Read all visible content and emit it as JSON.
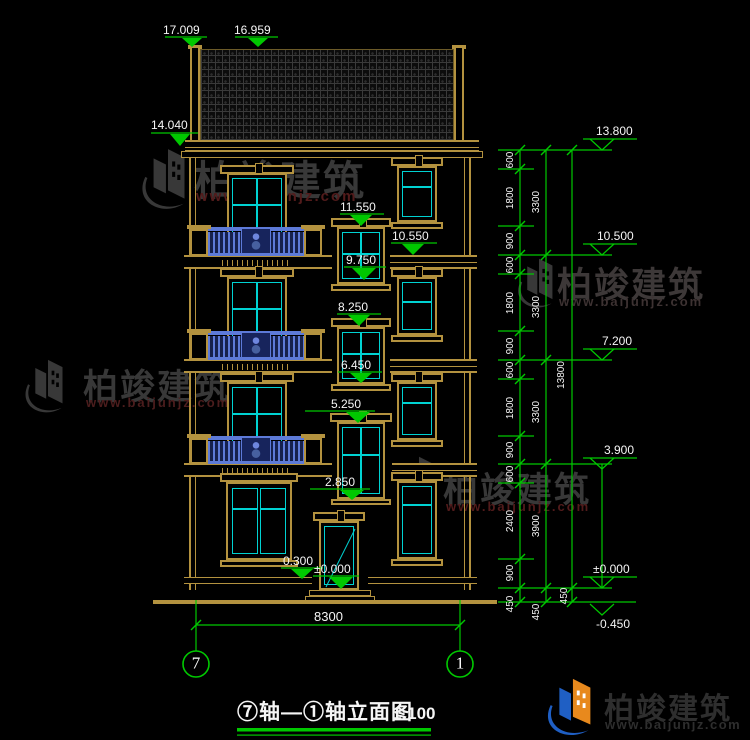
{
  "drawing": {
    "title": "⑦轴—①轴立面图",
    "scale": "1:100",
    "axis_left": "7",
    "axis_right": "1",
    "overall_width": "8300",
    "levels_facade": {
      "ridge_left": "17.009",
      "ridge_right": "16.959",
      "eave": "14.040",
      "w4_top": "11.550",
      "f4_band": "10.550",
      "w4_sill": "9.750",
      "w3_top": "8.250",
      "w3_sill": "6.450",
      "w2_top": "5.250",
      "w2_sill": "2.850",
      "porch": "0.300",
      "zero": "±0.000"
    },
    "levels_right": {
      "parapet": "13.800",
      "floor4": "10.500",
      "floor3": "7.200",
      "floor2": "3.900",
      "zero": "±0.000",
      "ground": "-0.450"
    },
    "dims": {
      "chain_inner": [
        "600",
        "1800",
        "900",
        "600",
        "1800",
        "900",
        "600",
        "1800",
        "900",
        "600",
        "2400",
        "900",
        "450"
      ],
      "chain_floor": [
        "3300",
        "3300",
        "3300",
        "3900",
        "450"
      ],
      "chain_total": [
        "13800",
        "450"
      ]
    }
  },
  "watermark": {
    "name": "柏竣建筑",
    "site": "www.baijunjz.com"
  },
  "logo": {
    "name": "柏竣建筑",
    "site": "www.baijunjz.com"
  },
  "colors": {
    "line_tan": "#b3923f",
    "line_cyan": "#00d2d2",
    "line_green": "#00c800",
    "railing_blue": "#5d7ad8",
    "text_white": "#f5f5f5"
  }
}
